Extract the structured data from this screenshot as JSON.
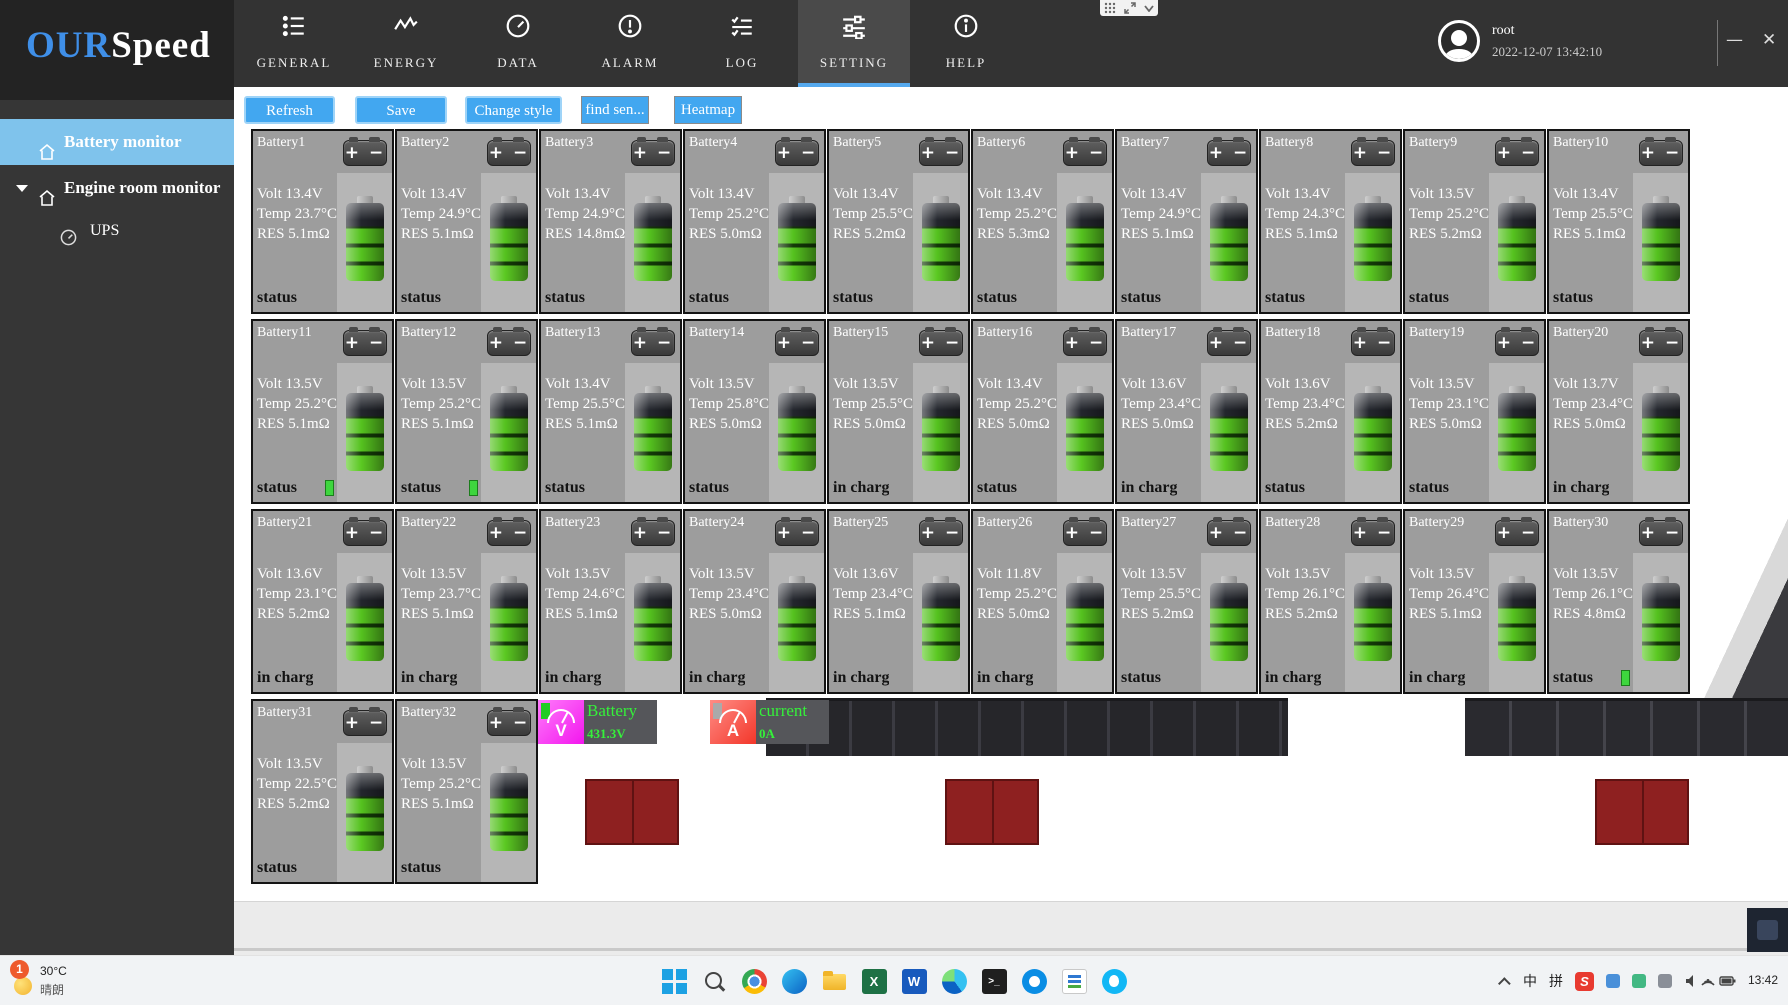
{
  "header": {
    "logo": {
      "part1": "OUR",
      "part2": "Speed"
    },
    "tabs": [
      {
        "label": "GENERAL",
        "icon": "list-icon",
        "active": false
      },
      {
        "label": "ENERGY",
        "icon": "wave-icon",
        "active": false
      },
      {
        "label": "DATA",
        "icon": "gauge-icon",
        "active": false
      },
      {
        "label": "ALARM",
        "icon": "alarm-icon",
        "active": false
      },
      {
        "label": "LOG",
        "icon": "log-icon",
        "active": false
      },
      {
        "label": "SETTING",
        "icon": "sliders-icon",
        "active": true
      },
      {
        "label": "HELP",
        "icon": "info-icon",
        "active": false
      }
    ],
    "user": {
      "name": "root",
      "datetime": "2022-12-07 13:42:10"
    },
    "window_controls": {
      "minimize": "—",
      "close": "✕"
    }
  },
  "sidebar": {
    "items": [
      {
        "label": "Battery monitor",
        "icon": "home-icon",
        "active": true
      },
      {
        "label": "Engine room monitor",
        "icon": "home-icon",
        "active": false
      },
      {
        "label": "UPS",
        "icon": "gauge-icon",
        "active": false
      }
    ]
  },
  "toolbar": {
    "buttons": [
      {
        "label": "Refresh"
      },
      {
        "label": "Save"
      },
      {
        "label": "Change style"
      },
      {
        "label": "find sen..."
      },
      {
        "label": "Heatmap"
      }
    ]
  },
  "batteries": [
    {
      "name": "Battery1",
      "volt": "Volt 13.4V",
      "temp": "Temp 23.7°C",
      "res": "RES 5.1mΩ",
      "status": "status",
      "indicator": false
    },
    {
      "name": "Battery2",
      "volt": "Volt 13.4V",
      "temp": "Temp 24.9°C",
      "res": "RES 5.1mΩ",
      "status": "status",
      "indicator": false
    },
    {
      "name": "Battery3",
      "volt": "Volt 13.4V",
      "temp": "Temp 24.9°C",
      "res": "RES 14.8mΩ",
      "status": "status",
      "indicator": false
    },
    {
      "name": "Battery4",
      "volt": "Volt 13.4V",
      "temp": "Temp 25.2°C",
      "res": "RES 5.0mΩ",
      "status": "status",
      "indicator": false
    },
    {
      "name": "Battery5",
      "volt": "Volt 13.4V",
      "temp": "Temp 25.5°C",
      "res": "RES 5.2mΩ",
      "status": "status",
      "indicator": false
    },
    {
      "name": "Battery6",
      "volt": "Volt 13.4V",
      "temp": "Temp 25.2°C",
      "res": "RES 5.3mΩ",
      "status": "status",
      "indicator": false
    },
    {
      "name": "Battery7",
      "volt": "Volt 13.4V",
      "temp": "Temp 24.9°C",
      "res": "RES 5.1mΩ",
      "status": "status",
      "indicator": false
    },
    {
      "name": "Battery8",
      "volt": "Volt 13.4V",
      "temp": "Temp 24.3°C",
      "res": "RES 5.1mΩ",
      "status": "status",
      "indicator": false
    },
    {
      "name": "Battery9",
      "volt": "Volt 13.5V",
      "temp": "Temp 25.2°C",
      "res": "RES 5.2mΩ",
      "status": "status",
      "indicator": false
    },
    {
      "name": "Battery10",
      "volt": "Volt 13.4V",
      "temp": "Temp 25.5°C",
      "res": "RES 5.1mΩ",
      "status": "status",
      "indicator": false
    },
    {
      "name": "Battery11",
      "volt": "Volt 13.5V",
      "temp": "Temp 25.2°C",
      "res": "RES 5.1mΩ",
      "status": "status",
      "indicator": true
    },
    {
      "name": "Battery12",
      "volt": "Volt 13.5V",
      "temp": "Temp 25.2°C",
      "res": "RES 5.1mΩ",
      "status": "status",
      "indicator": true
    },
    {
      "name": "Battery13",
      "volt": "Volt 13.4V",
      "temp": "Temp 25.5°C",
      "res": "RES 5.1mΩ",
      "status": "status",
      "indicator": false
    },
    {
      "name": "Battery14",
      "volt": "Volt 13.5V",
      "temp": "Temp 25.8°C",
      "res": "RES 5.0mΩ",
      "status": "status",
      "indicator": false
    },
    {
      "name": "Battery15",
      "volt": "Volt 13.5V",
      "temp": "Temp 25.5°C",
      "res": "RES 5.0mΩ",
      "status": "in charg",
      "indicator": false
    },
    {
      "name": "Battery16",
      "volt": "Volt 13.4V",
      "temp": "Temp 25.2°C",
      "res": "RES 5.0mΩ",
      "status": "status",
      "indicator": false
    },
    {
      "name": "Battery17",
      "volt": "Volt 13.6V",
      "temp": "Temp 23.4°C",
      "res": "RES 5.0mΩ",
      "status": "in charg",
      "indicator": false
    },
    {
      "name": "Battery18",
      "volt": "Volt 13.6V",
      "temp": "Temp 23.4°C",
      "res": "RES 5.2mΩ",
      "status": "status",
      "indicator": false
    },
    {
      "name": "Battery19",
      "volt": "Volt 13.5V",
      "temp": "Temp 23.1°C",
      "res": "RES 5.0mΩ",
      "status": "status",
      "indicator": false
    },
    {
      "name": "Battery20",
      "volt": "Volt 13.7V",
      "temp": "Temp 23.4°C",
      "res": "RES 5.0mΩ",
      "status": "in charg",
      "indicator": false
    },
    {
      "name": "Battery21",
      "volt": "Volt 13.6V",
      "temp": "Temp 23.1°C",
      "res": "RES 5.2mΩ",
      "status": "in charg",
      "indicator": false
    },
    {
      "name": "Battery22",
      "volt": "Volt 13.5V",
      "temp": "Temp 23.7°C",
      "res": "RES 5.1mΩ",
      "status": "in charg",
      "indicator": false
    },
    {
      "name": "Battery23",
      "volt": "Volt 13.5V",
      "temp": "Temp 24.6°C",
      "res": "RES 5.1mΩ",
      "status": "in charg",
      "indicator": false
    },
    {
      "name": "Battery24",
      "volt": "Volt 13.5V",
      "temp": "Temp 23.4°C",
      "res": "RES 5.0mΩ",
      "status": "in charg",
      "indicator": false
    },
    {
      "name": "Battery25",
      "volt": "Volt 13.6V",
      "temp": "Temp 23.4°C",
      "res": "RES 5.1mΩ",
      "status": "in charg",
      "indicator": false
    },
    {
      "name": "Battery26",
      "volt": "Volt 11.8V",
      "temp": "Temp 25.2°C",
      "res": "RES 5.0mΩ",
      "status": "in charg",
      "indicator": false
    },
    {
      "name": "Battery27",
      "volt": "Volt 13.5V",
      "temp": "Temp 25.5°C",
      "res": "RES 5.2mΩ",
      "status": "status",
      "indicator": false
    },
    {
      "name": "Battery28",
      "volt": "Volt 13.5V",
      "temp": "Temp 26.1°C",
      "res": "RES 5.2mΩ",
      "status": "in charg",
      "indicator": false
    },
    {
      "name": "Battery29",
      "volt": "Volt 13.5V",
      "temp": "Temp 26.4°C",
      "res": "RES 5.1mΩ",
      "status": "in charg",
      "indicator": false
    },
    {
      "name": "Battery30",
      "volt": "Volt 13.5V",
      "temp": "Temp 26.1°C",
      "res": "RES 4.8mΩ",
      "status": "status",
      "indicator": true
    },
    {
      "name": "Battery31",
      "volt": "Volt 13.5V",
      "temp": "Temp 22.5°C",
      "res": "RES 5.2mΩ",
      "status": "status",
      "indicator": false
    },
    {
      "name": "Battery32",
      "volt": "Volt 13.5V",
      "temp": "Temp 25.2°C",
      "res": "RES 5.1mΩ",
      "status": "status",
      "indicator": false
    }
  ],
  "meters": [
    {
      "label": "Battery",
      "value": "431.3V",
      "letter": "V",
      "color": "#f316ee"
    },
    {
      "label": "current",
      "value": "0A",
      "letter": "A",
      "color": "#f3362a"
    }
  ],
  "taskbar": {
    "weather": {
      "badge": "1",
      "temp": "30°C",
      "desc": "晴朗"
    },
    "icons": [
      "start",
      "search",
      "chrome",
      "edge",
      "folder",
      "excel",
      "word",
      "browser",
      "terminal",
      "chat",
      "docs",
      "messenger"
    ],
    "tray": {
      "ime_lang": "中",
      "ime_mode": "拼",
      "sogou": "S",
      "time": "13:42"
    }
  }
}
